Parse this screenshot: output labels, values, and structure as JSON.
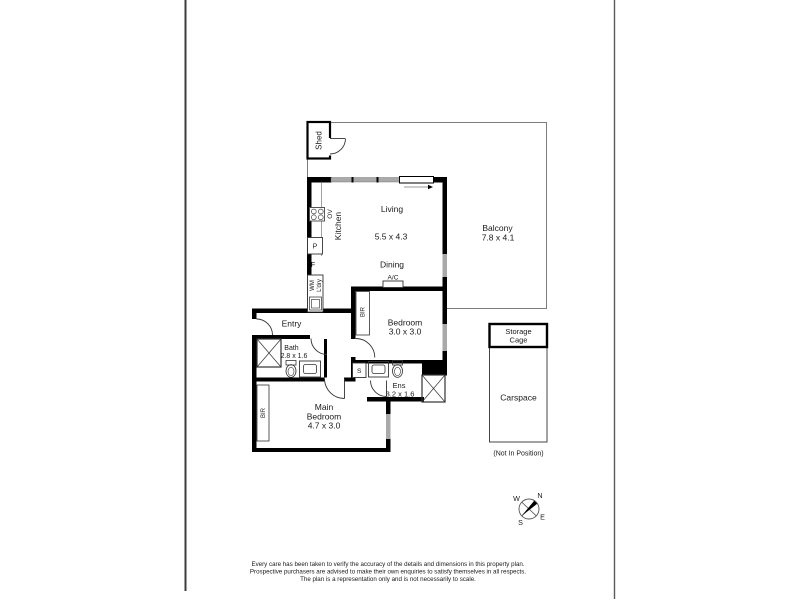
{
  "plan": {
    "rooms": {
      "shed": "Shed",
      "living": {
        "name": "Living",
        "dims": "5.5 x 4.3"
      },
      "balcony": {
        "name": "Balcony",
        "dims": "7.8 x 4.1"
      },
      "dining": "Dining",
      "kitchen": "Kitchen",
      "entry": "Entry",
      "bath": {
        "name": "Bath",
        "dims": "2.8 x 1.6"
      },
      "bedroom": {
        "name": "Bedroom",
        "dims": "3.0 x 3.0"
      },
      "ensuite": {
        "name": "Ens",
        "dims": "3.2 x 1.6"
      },
      "main_bedroom": {
        "line1": "Main",
        "line2": "Bedroom",
        "dims": "4.7 x 3.0"
      },
      "storage_cage": {
        "line1": "Storage",
        "line2": "Cage"
      },
      "carspace": {
        "name": "Carspace",
        "note": "(Not In Position)"
      }
    },
    "fixtures": {
      "oven": "OV",
      "pantry": "P",
      "fridge": "F",
      "washing_machine": "WM",
      "laundry": "L'dry",
      "air_conditioner": "A/C",
      "built_in_robe": "BIR",
      "storage_cupboard": "S"
    },
    "compass": {
      "north": "N",
      "south": "S",
      "east": "E",
      "west": "W"
    }
  },
  "footer": {
    "disclaimer_line1": "Every care has been taken to verify the accuracy of the details and dimensions in this property plan.",
    "disclaimer_line2": "Prospective purchasers are advised to make their own enquiries to satisfy themselves in all respects.",
    "disclaimer_line3": "The plan is a representation only and is not necessarily to scale."
  },
  "colors": {
    "wall": "#000000",
    "window": "#a9a9a9",
    "thin_line": "#7d7d7d",
    "text": "#1a1a1a"
  }
}
